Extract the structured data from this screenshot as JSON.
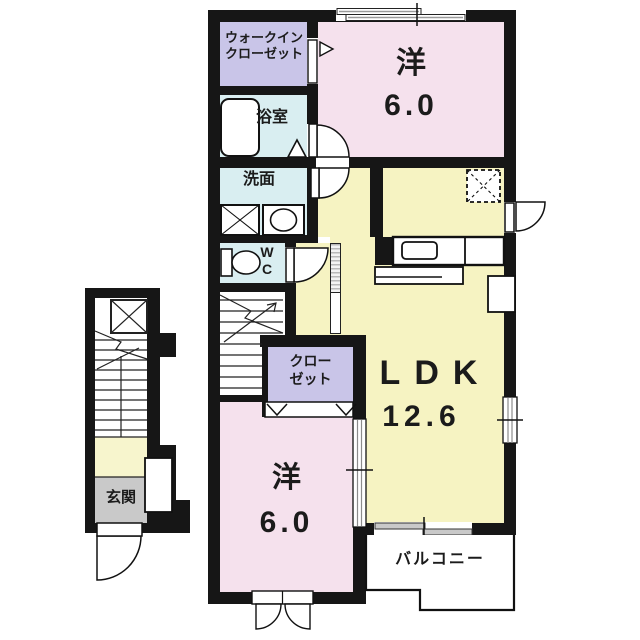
{
  "rooms": {
    "walk_in_closet": {
      "label_line1": "ウォークイン",
      "label_line2": "クローゼット"
    },
    "bathroom": {
      "label": "浴室"
    },
    "washroom": {
      "label": "洗面"
    },
    "toilet": {
      "label_line1": "W",
      "label_line2": "C"
    },
    "bedroom_top": {
      "label": "洋",
      "size": "6.0"
    },
    "ldk": {
      "label": "LDK",
      "size": "12.6"
    },
    "closet": {
      "label_line1": "クロー",
      "label_line2": "ゼット"
    },
    "bedroom_bottom": {
      "label": "洋",
      "size": "6.0"
    },
    "balcony": {
      "label": "バルコニー"
    },
    "entrance": {
      "label": "玄関"
    }
  },
  "colors": {
    "room_pink": "#f5e1ed",
    "room_yellow": "#f6f3c2",
    "room_lavender": "#c9c5e8",
    "room_cyan": "#d9eef1",
    "entrance_gray": "#c9c9c9",
    "landing_yellow": "#f7f5cd",
    "wall_black": "#161616"
  }
}
